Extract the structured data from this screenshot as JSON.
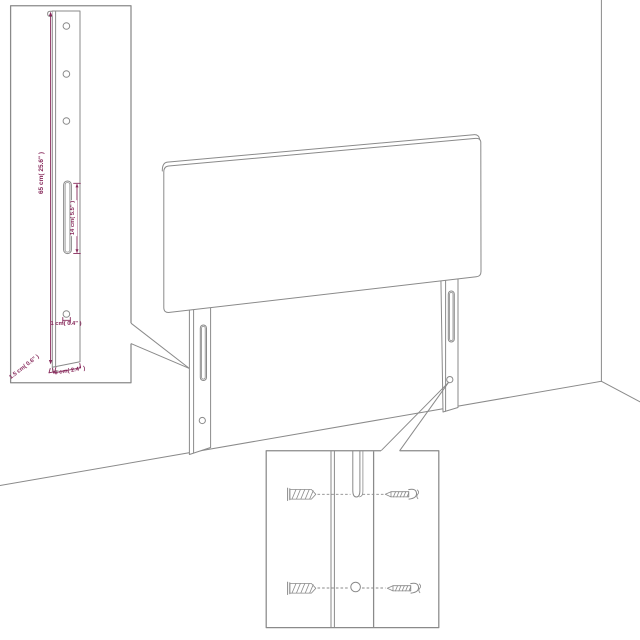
{
  "canvas": {
    "width": 640,
    "height": 640,
    "background": "#ffffff"
  },
  "colors": {
    "line": "#8a8a8a",
    "dimension": "#86285a",
    "fill": "#ffffff"
  },
  "diagram": {
    "subject": "headboard-assembly-dimension-diagram",
    "scene": "upholstered headboard panel with two wall-mount legs standing in a room corner, grey line art",
    "labels": {
      "height": "65 cm( 25.6\" )",
      "slot_length": "14 cm( 5.5\" )",
      "hole_diameter": "1 cm( 0.4\" )",
      "leg_thickness": "1.5 cm( 0.6\" )",
      "leg_width": "6 cm( 2.4\" )"
    },
    "insets": {
      "left": "enlarged mounting leg: three holes at top, long center slot, small hole near bottom, dimension lines",
      "bottom_right": "mounting hardware: wall plugs aligned with leg slot and hole, screws"
    },
    "icons": [
      "wall-plug-icon",
      "screw-icon"
    ]
  }
}
